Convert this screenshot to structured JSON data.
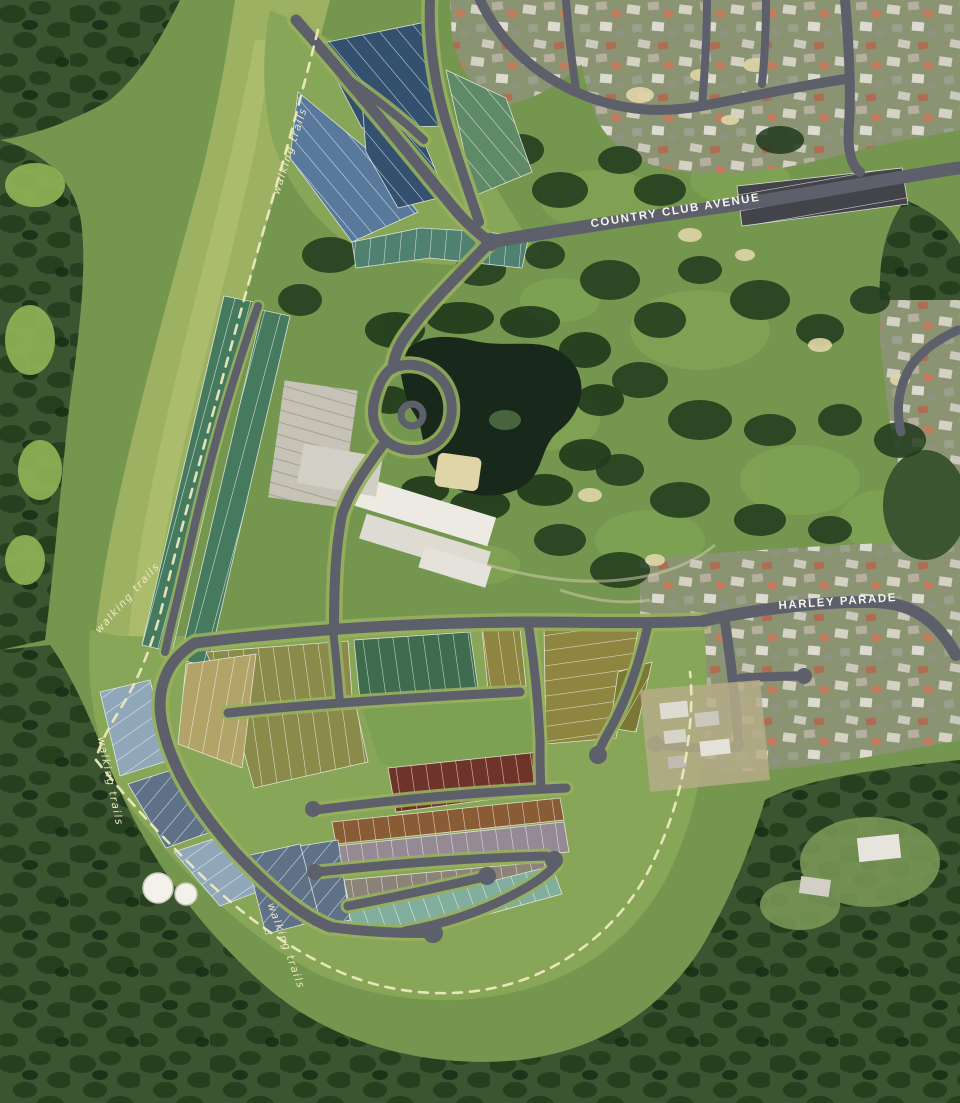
{
  "map": {
    "street_labels": [
      {
        "text": "COUNTRY CLUB AVENUE"
      },
      {
        "text": "HARLEY PARADE"
      }
    ],
    "trail_label": {
      "text": "walking trails"
    },
    "colors": {
      "golf_base": "#74964e",
      "field": "#9db163",
      "field_light": "#b2c173",
      "buffer": "#88a657",
      "meadow": "#7da153",
      "forest": "#3a5530",
      "forest_dark": "#203a1c",
      "suburb_base": "#8a9473",
      "lake": "#18281a",
      "sand": "#e0d5a8",
      "road": "#5d5f6b",
      "road_verge": "#97b05e",
      "trail": "#ece9c0",
      "trail_text": "#efe9c4",
      "label_text": "#f5f4ee",
      "lots": {
        "navy": "#33516e",
        "blue": "#58799b",
        "teal": "#4f8070",
        "sage": "#5f8a68",
        "green_col": "#457a5f",
        "dk_green": "#3f6b4f",
        "gold": "#8d8540",
        "olive": "#7a7834",
        "khaki": "#8a8a4a",
        "wheat": "#b2a468",
        "maroon": "#6f3429",
        "sienna": "#8a5c36",
        "mauve": "#958a94",
        "taupe": "#8b8278",
        "seafoam": "#82af9d",
        "slate": "#5e7186",
        "ltblue": "#8fa7b8",
        "charcoal": "#43434a"
      }
    }
  }
}
